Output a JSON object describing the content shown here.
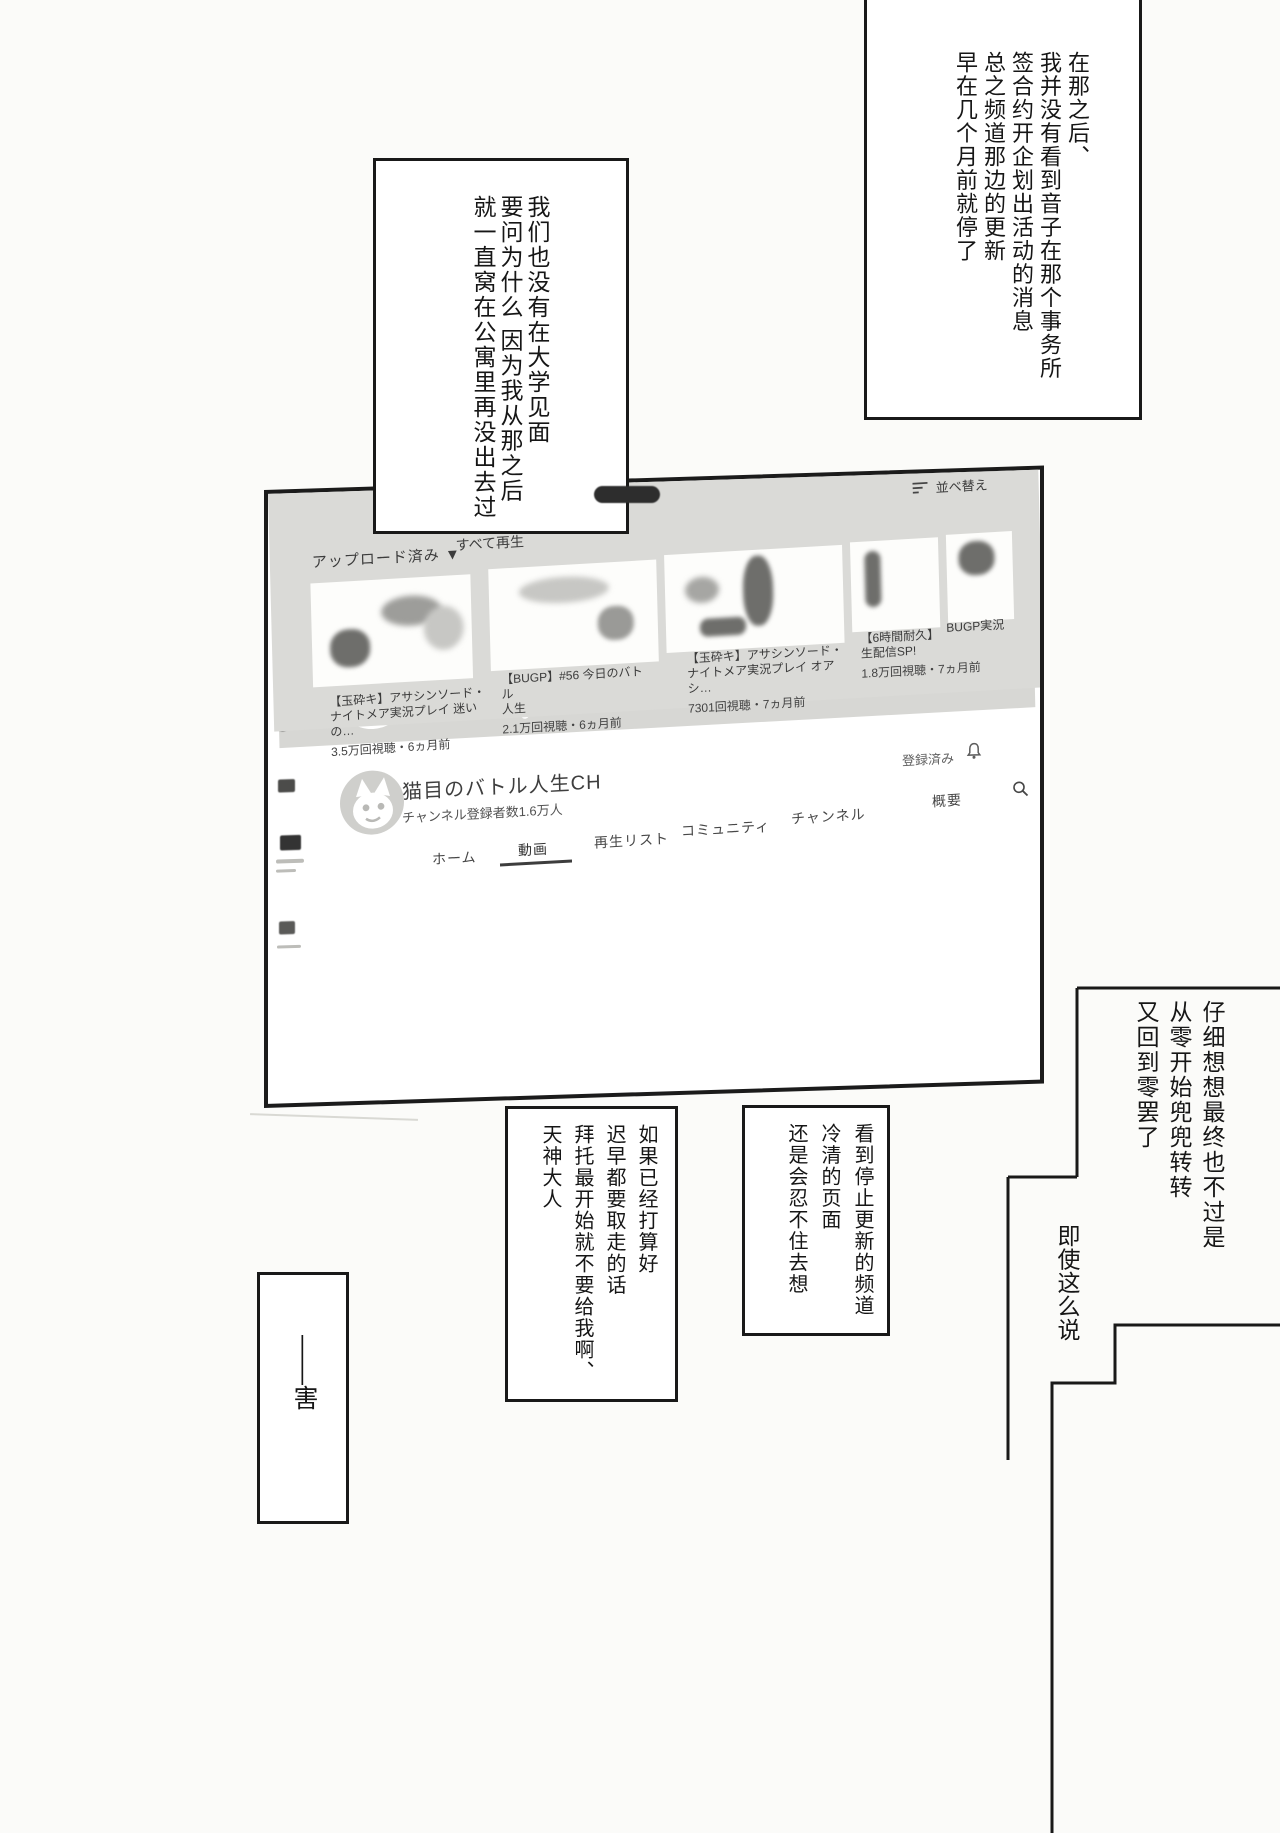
{
  "page": {
    "background": "#fbfbf9",
    "ink": "#191919"
  },
  "speech": {
    "box1": {
      "text": "在那之后、\n我并没有看到音子在那个事务所\n签合约开企划出活动的消息\n总之频道那边的更新\n早在几个月前就停了"
    },
    "box2": {
      "text": "我们也没有在大学见面\n要问为什么 因为我从那之后\n就一直窝在公寓里再没出去过"
    },
    "box3": {
      "text": "仔细想想最终也不过是\n从零开始兜兜转转\n又回到零罢了"
    },
    "box4": {
      "text": "即使这么说"
    },
    "box5": {
      "text": "看到停止更新的频道\n冷清的页面\n还是会忍不住去想"
    },
    "box6": {
      "text": "如果已经打算好\n迟早都要取走的话\n拜托最开始就不要给我啊、\n天神大人"
    },
    "box7": {
      "text": "——害"
    }
  },
  "browser": {
    "tab_title": "猫目のバトル人生CH・Yo",
    "jp_mark": "JP"
  },
  "youtube": {
    "search_label": "検索",
    "banner_text": "Battle人生!!",
    "channel_name": "猫目のバトル人生CH",
    "subscribers": "チャンネル登録者数1.6万人",
    "subscribed_label": "登録済み",
    "tabs": [
      "ホーム",
      "動画",
      "再生リスト",
      "コミュニティ",
      "チャンネル",
      "概要"
    ],
    "uploads_label": "アップロード済み ▼",
    "play_all_label": "すべて再生",
    "sort_label": "並べ替え",
    "videos": [
      {
        "title": "【玉砕キ】アサシンソード・\nナイトメア実況プレイ 迷いの…",
        "views": "3.5万回視聴・6ヵ月前"
      },
      {
        "title": "【BUGP】#56 今日のバトル\n人生",
        "views": "2.1万回視聴・6ヵ月前"
      },
      {
        "title": "【玉砕キ】アサシンソード・\nナイトメア実況プレイ オアシ…",
        "views": "7301回視聴・7ヵ月前"
      },
      {
        "title": "【6時間耐久】\n生配信SP!",
        "views": "1.8万回視聴・7ヵ月前"
      },
      {
        "title": "BUGP実況",
        "views": ""
      }
    ]
  }
}
